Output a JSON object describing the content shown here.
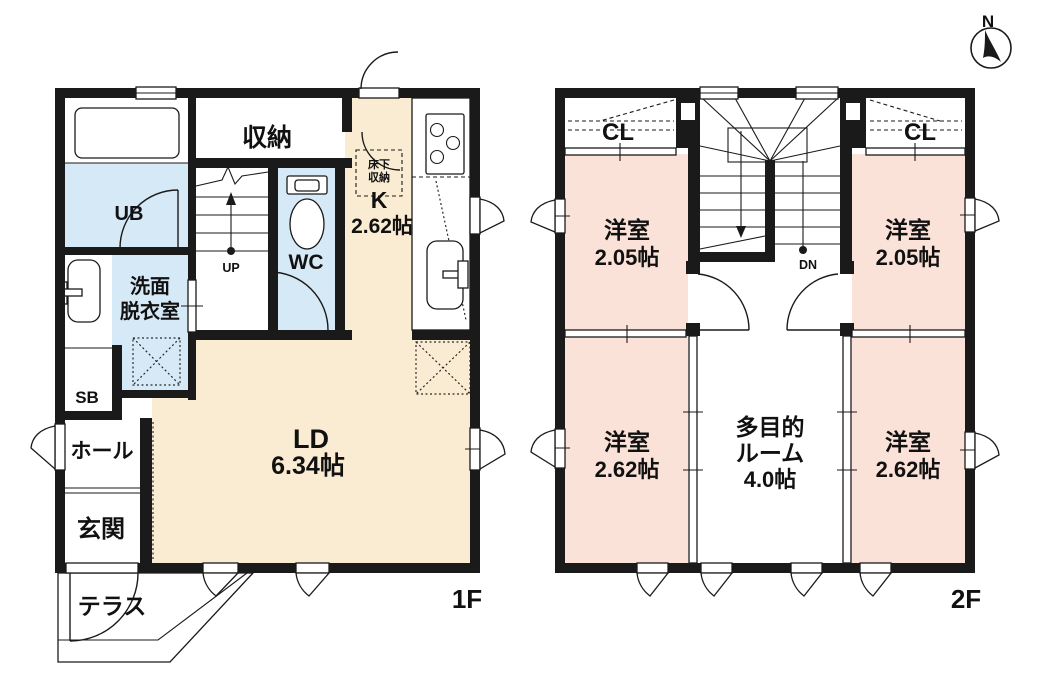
{
  "colors": {
    "cream": "#FAECD2",
    "pink": "#FBE2D9",
    "blue": "#D6E9F6",
    "wall": "#1A1A1A"
  },
  "compass": {
    "north": "N"
  },
  "floor1": {
    "name": "1F",
    "rooms": {
      "storage": "収納",
      "unit_bath": "UB",
      "washroom_line1": "洗面",
      "washroom_line2": "脱衣室",
      "toilet": "WC",
      "kitchen_label": "K",
      "kitchen_size": "2.62帖",
      "underfloor_line1": "床下",
      "underfloor_line2": "収納",
      "shoe_box": "SB",
      "hall": "ホール",
      "entrance": "玄関",
      "living_label": "LD",
      "living_size": "6.34帖",
      "terrace": "テラス",
      "stairs_up": "UP"
    }
  },
  "floor2": {
    "name": "2F",
    "rooms": {
      "closet_left": "CL",
      "closet_right": "CL",
      "bedroom_tl_label": "洋室",
      "bedroom_tl_size": "2.05帖",
      "bedroom_tr_label": "洋室",
      "bedroom_tr_size": "2.05帖",
      "bedroom_bl_label": "洋室",
      "bedroom_bl_size": "2.62帖",
      "bedroom_br_label": "洋室",
      "bedroom_br_size": "2.62帖",
      "multi_line1": "多目的",
      "multi_line2": "ルーム",
      "multi_size": "4.0帖",
      "stairs_dn": "DN"
    }
  }
}
